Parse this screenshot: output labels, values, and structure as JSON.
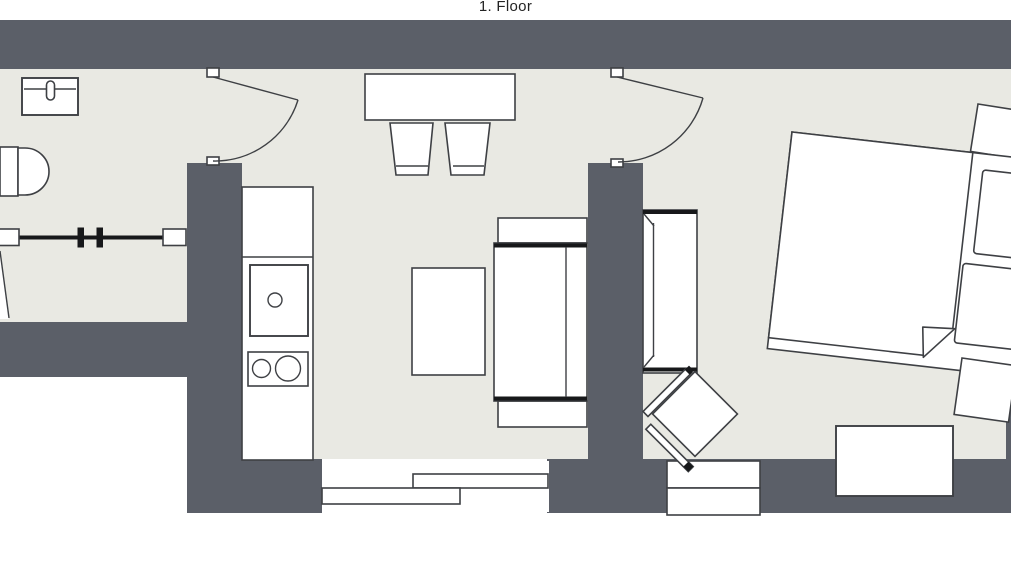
{
  "title": "1. Floor",
  "colors": {
    "wall": "#5b5f68",
    "floor": "#e9e9e3",
    "line": "#3e4044",
    "ink": "#17181a",
    "paper": "#ffffff",
    "title_text": "#232323"
  },
  "rooms": {
    "bathroom": {
      "items": [
        "washbasin",
        "toilet",
        "shower-screen"
      ]
    },
    "kitchen_living": {
      "items": [
        "kitchenette",
        "sink",
        "cooktop",
        "dining-table",
        "chair",
        "chair",
        "coffee-table",
        "sofa",
        "sliding-window"
      ]
    },
    "bedroom": {
      "items": [
        "wardrobe",
        "armchair",
        "double-bed",
        "pillow",
        "pillow",
        "nightstand",
        "nightstand",
        "chest",
        "window"
      ]
    },
    "doors": [
      "swing-door-living",
      "swing-door-bedroom"
    ]
  }
}
